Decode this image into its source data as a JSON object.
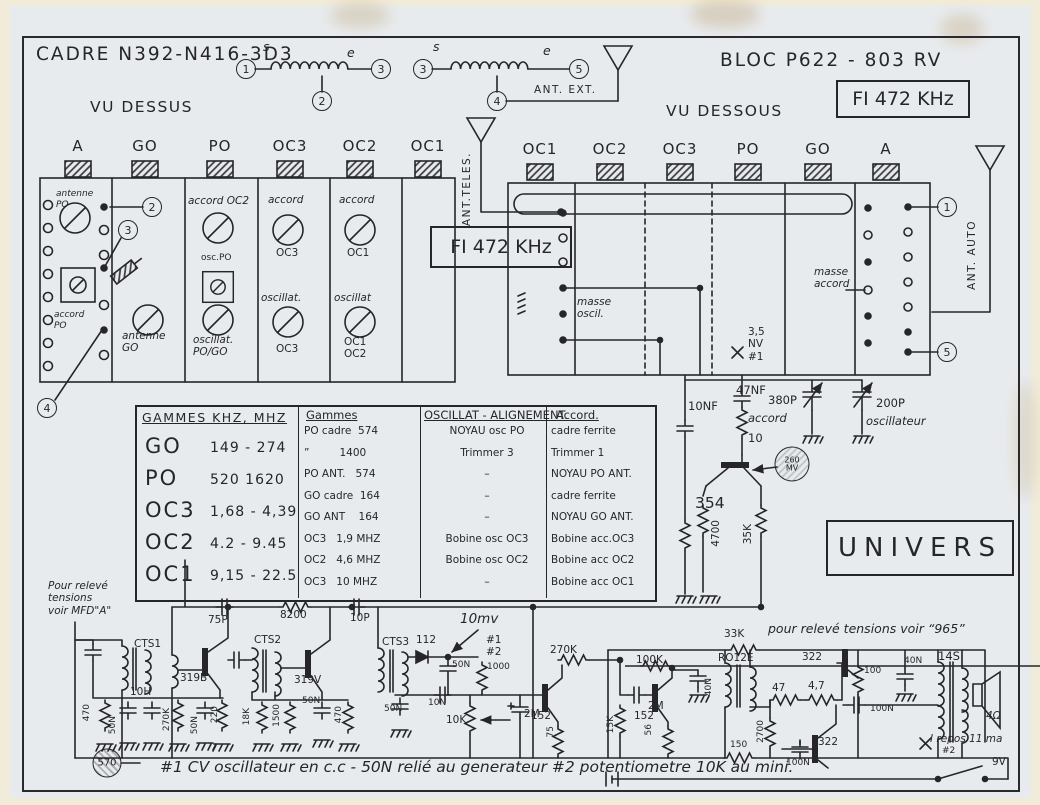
{
  "page": {
    "title_left": "CADRE N392-N416-3D3",
    "title_right": "BLOC P622 - 803 RV",
    "fi": "FI 472 KHz",
    "vu_dessus": "VU DESSUS",
    "vu_dessous": "VU DESSOUS",
    "univers": "UNIVERS"
  },
  "top_link": {
    "n1": "1",
    "n2": "2",
    "n3a": "3",
    "n3b": "3",
    "n4": "4",
    "n5": "5",
    "s1": "s",
    "e1": "e",
    "s2": "s",
    "e2": "e",
    "ant_ext": "ANT. EXT.",
    "ant_teles": "ANT.TELES.",
    "ant_auto": "ANT. AUTO"
  },
  "left_panel": {
    "columns": [
      "A",
      "GO",
      "PO",
      "OC3",
      "OC2",
      "OC1"
    ],
    "antenne_po": "antenne\nPO",
    "accord_po": "accord\nPO",
    "antenne_go": "antenne\nGO",
    "accord_oc2": "accord OC2",
    "osc_po": "osc.PO",
    "oscillat_pogo": "oscillat.\nPO/GO",
    "accord_oc3": "accord",
    "oc3_a": "OC3",
    "oscillat_oc3": "oscillat.",
    "oc3_b": "OC3",
    "accord_oc1": "accord",
    "oc1_a": "OC1",
    "oscillat_oc12": "oscillat",
    "oc1_b": "OC1\nOC2",
    "ref2": "2",
    "ref3": "3",
    "ref4": "4"
  },
  "right_panel": {
    "columns": [
      "OC1",
      "OC2",
      "OC3",
      "PO",
      "GO",
      "A"
    ],
    "masse_oscil": "masse\noscil.",
    "masse_accord": "masse\naccord",
    "nv": "3,5\nNV\n#1",
    "ref1": "1",
    "ref5": "5"
  },
  "mid": {
    "c10nf": "10NF",
    "c47nf": "47NF",
    "c380p": "380P",
    "accord": "accord",
    "r10": "10",
    "c200p": "200P",
    "oscillateur": "oscillateur",
    "t354": "354",
    "mv260": "260\nMV",
    "r4700": "4700",
    "r35k": "35K"
  },
  "tables": {
    "gammes": {
      "title": "GAMMES KHZ, MHZ",
      "rows": [
        {
          "band": "GO",
          "range": "149 - 274"
        },
        {
          "band": "PO",
          "range": "520  1620"
        },
        {
          "band": "OC3",
          "range": "1,68 - 4,39"
        },
        {
          "band": "OC2",
          "range": "4.2 - 9.45"
        },
        {
          "band": "OC1",
          "range": "9,15 - 22.5"
        }
      ]
    },
    "align": {
      "h_gammes": "Gammes",
      "h_oscillat": "OSCILLAT - ALIGNEMENT.",
      "h_accord": "Accord.",
      "rows": [
        {
          "g": "PO cadre  574",
          "o": "NOYAU osc PO",
          "a": "cadre ferrite"
        },
        {
          "g": "”         1400",
          "o": "Trimmer 3",
          "a": "Trimmer 1"
        },
        {
          "g": "PO ANT.   574",
          "o": "–",
          "a": "NOYAU PO ANT."
        },
        {
          "g": "GO cadre  164",
          "o": "–",
          "a": "cadre ferrite"
        },
        {
          "g": "GO ANT    164",
          "o": "–",
          "a": "NOYAU GO ANT."
        },
        {
          "g": "OC3   1,9 MHZ",
          "o": "Bobine osc OC3",
          "a": "Bobine acc.OC3"
        },
        {
          "g": "OC2   4,6 MHZ",
          "o": "Bobine osc OC2",
          "a": "Bobine acc OC2"
        },
        {
          "g": "OC3   10 MHZ",
          "o": "–",
          "a": "Bobine acc OC1"
        }
      ]
    }
  },
  "notes": {
    "pour_releve": "Pour relevé\ntensions\nvoir MFD\"A\"",
    "releve_965": "pour relevé tensions voir “965”",
    "footer": "#1  CV oscillateur en c.c - 50N relié au generateur  #2  potentiometre 10K au mini.",
    "mv10": "10mv",
    "hash12": "#1\n#2",
    "i_repos": "I repos 11 ma",
    "i_repos_ref": "#2",
    "battery": "9V"
  },
  "bl": {
    "cts1": "CTS1",
    "t319b": "319B",
    "c75p": "75P",
    "r8200": "8200",
    "c10p": "10P",
    "cts2": "CTS2",
    "t319v": "319V",
    "cts3": "CTS3",
    "d112": "112",
    "c50n_a": "50N",
    "r1000": "1000",
    "c50n_b": "50N",
    "c10n": "10N",
    "r10k": "10K",
    "c2m_a": "2M",
    "t152a": "152",
    "r270k": "270K",
    "r75": "75",
    "r15k": "15K",
    "c2m_b": "2M",
    "t152b": "152",
    "r100k": "100K",
    "r56": "56",
    "c40n_a": "40N",
    "r33k": "33K",
    "ro12e": "RO12E",
    "t322a": "322",
    "r47": "47",
    "r4_7": "4,7",
    "r100": "100",
    "c40n_b": "40N",
    "c100n_a": "100N",
    "t14s": "14S",
    "spk": "4Ω",
    "r470a": "470",
    "c50n_c": "50N",
    "l10h": "10H",
    "r270k_b": "270K",
    "c50n_d": "50N",
    "r220": "220",
    "r18k": "18K",
    "r1500": "1500",
    "c50n_e": "50N",
    "r470b": "470",
    "j570": "570",
    "r150": "150",
    "r2700": "2700",
    "t322b": "322",
    "c100n_b": "100N"
  }
}
